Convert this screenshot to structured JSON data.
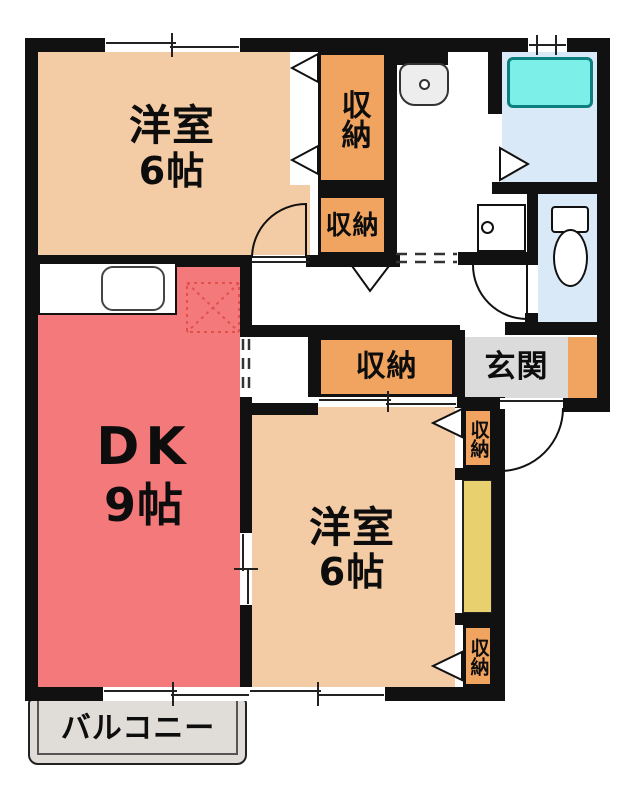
{
  "plan_title": "apartment floor plan",
  "rooms": {
    "western_room_top": {
      "label": "洋室",
      "area": "6帖"
    },
    "dining_kitchen": {
      "label": "DK",
      "area": "9帖"
    },
    "western_room_bottom": {
      "label": "洋室",
      "area": "6帖"
    },
    "entrance": {
      "label": "玄関"
    },
    "balcony": {
      "label": "バルコニー"
    },
    "closet": {
      "label": "収納"
    }
  },
  "fixtures": {
    "bathtub": "bathtub",
    "toilet": "toilet",
    "washbasin": "washbasin",
    "washing_machine_pan": "washing-machine-pan",
    "kitchen_sink": "kitchen-sink",
    "refrigerator_space": "refrigerator-space-cross"
  },
  "colors": {
    "wall": "#111111",
    "western_room_fill": "#F3CBA4",
    "dk_fill": "#F4797B",
    "closet_fill": "#F0A45F",
    "entrance_floor": "#DBDBDB",
    "wet_area_floor": "#D9E9F7",
    "bathtub_fill": "#7DEFE9",
    "hall_strip": "#E9D06F",
    "balcony_floor": "#E0DCD7",
    "refrigerator_mark": "#E0514E"
  }
}
